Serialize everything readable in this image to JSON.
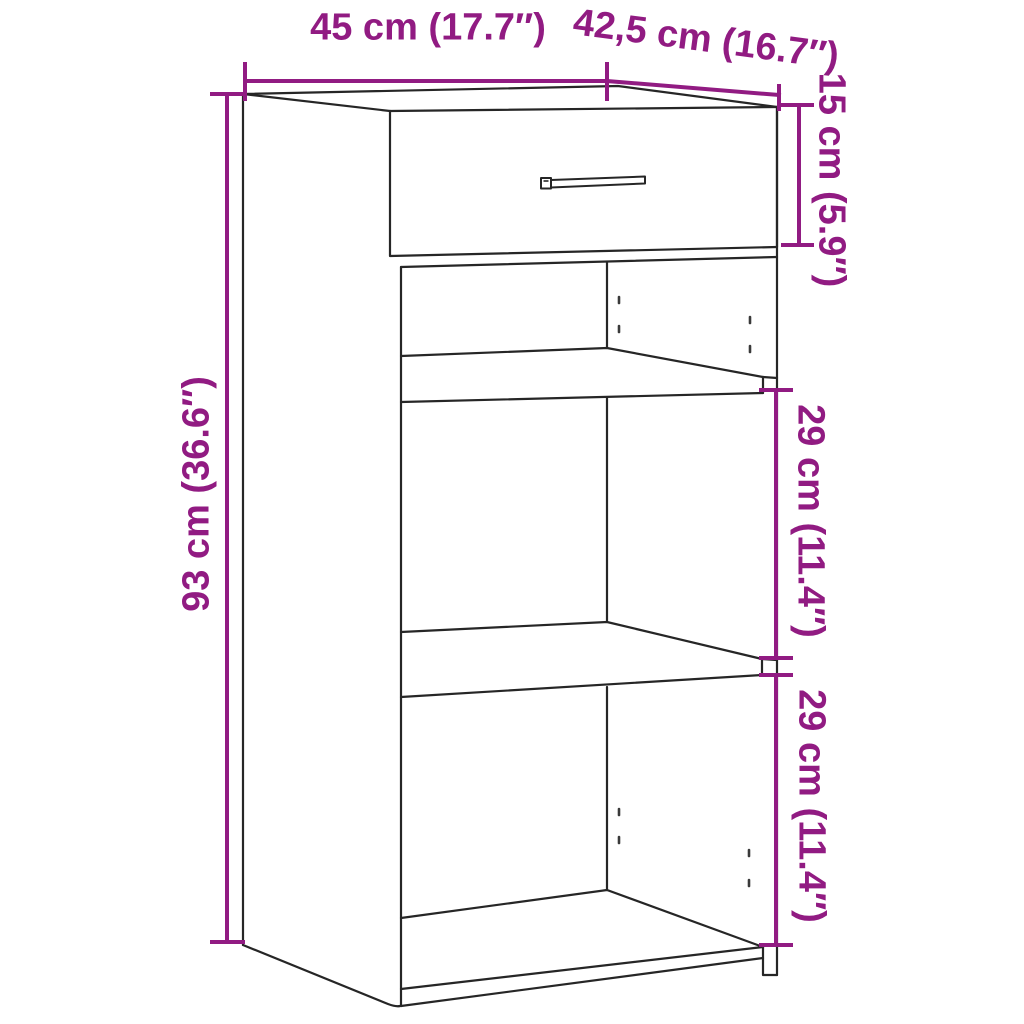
{
  "diagram": {
    "type": "furniture-dimension-drawing",
    "subject": "sideboard with one drawer and two open shelf compartments",
    "colors": {
      "dimension_accent": "#911b82",
      "outline": "#262626",
      "background": "#ffffff"
    },
    "dimensions": {
      "width_label": "45 cm (17.7″)",
      "depth_label": "42,5 cm (16.7″)",
      "drawer_height_label": "15 cm (5.9″)",
      "total_height_label": "93 cm (36.6″)",
      "middle_compartment_label": "29 cm (11.4″)",
      "bottom_compartment_label": "29 cm (11.4″)"
    }
  }
}
